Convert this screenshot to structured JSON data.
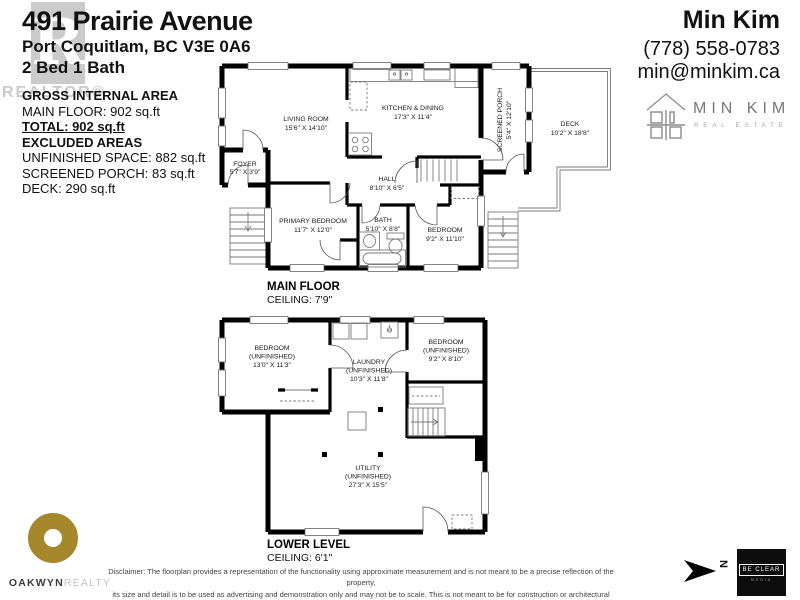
{
  "header": {
    "address": "491 Prairie Avenue",
    "city": "Port Coquitlam, BC V3E 0A6",
    "beds": "2 Bed 1 Bath"
  },
  "agent": {
    "name": "Min Kim",
    "phone": "(778) 558-0783",
    "email": "min@minkim.ca",
    "brand": "MIN KIM",
    "brand_sub": "REAL ESTATE"
  },
  "areas": {
    "title": "GROSS INTERNAL AREA",
    "main_floor": "MAIN FLOOR: 902 sq.ft",
    "total": "TOTAL: 902 sq.ft",
    "excluded_title": "EXCLUDED AREAS",
    "unfinished": "UNFINISHED SPACE: 882 sq.ft",
    "screened_porch": "SCREENED PORCH: 83 sq.ft",
    "deck": "DECK: 290 sq.ft"
  },
  "watermark": {
    "letter": "R",
    "label": "REALTOR®"
  },
  "main_floor": {
    "title": "MAIN FLOOR",
    "ceiling": "CEILING: 7'9\"",
    "rooms": {
      "living": {
        "name": "LIVING ROOM",
        "dims": "15'6\" X 14'10\""
      },
      "kitchen": {
        "name": "KITCHEN & DINING",
        "dims": "17'3\" X 11'4\""
      },
      "porch": {
        "name": "SCREENED PORCH",
        "dims": "5'4\" X 12'10\""
      },
      "deck": {
        "name": "DECK",
        "dims": "10'2\" X 18'8\""
      },
      "foyer": {
        "name": "FOYER",
        "dims": "5'7\" X 3'9\""
      },
      "hall": {
        "name": "HALL",
        "dims": "8'10\" X 6'5\""
      },
      "primary": {
        "name": "PRIMARY BEDROOM",
        "dims": "11'7\" X 12'0\""
      },
      "bath": {
        "name": "BATH",
        "dims": "5'10\" X 8'8\""
      },
      "bedroom": {
        "name": "BEDROOM",
        "dims": "9'2\" X 11'10\""
      }
    }
  },
  "lower_level": {
    "title": "LOWER LEVEL",
    "ceiling": "CEILING: 6'1\"",
    "rooms": {
      "bedroom_left": {
        "name": "BEDROOM",
        "sub": "(UNFINISHED)",
        "dims": "13'0\" X 11'3\""
      },
      "laundry": {
        "name": "LAUNDRY",
        "sub": "(UNFINISHED)",
        "dims": "10'3\" X 11'8\""
      },
      "bedroom_right": {
        "name": "BEDROOM",
        "sub": "(UNFINISHED)",
        "dims": "9'2\" X 8'10\""
      },
      "utility": {
        "name": "UTILITY",
        "sub": "(UNFINISHED)",
        "dims": "27'3\" X 15'5\""
      }
    }
  },
  "footer": {
    "disclaimer1": "Disclaimer: The floorplan provides a representation of the functionality using approximate measurement and is not meant to be a precise reflection of the property,",
    "disclaimer2": "its size and detail is to be used as advertising and demonstration only and may not be to scale. This is not meant to be for construction or architectural purposes. E&O INSURED.",
    "north_label": "N",
    "oakwyn": "OAKWYN",
    "oakwyn_sub": "REALTY",
    "beclear": "BE CLEAR",
    "beclear_sub": "MEDIA"
  },
  "colors": {
    "wall": "#000000",
    "oakwyn_gold": "#a5872c",
    "watermark_gray": "#cbcbcb",
    "brand_gray": "#777777",
    "beclear_bg": "#0d0d0d"
  }
}
